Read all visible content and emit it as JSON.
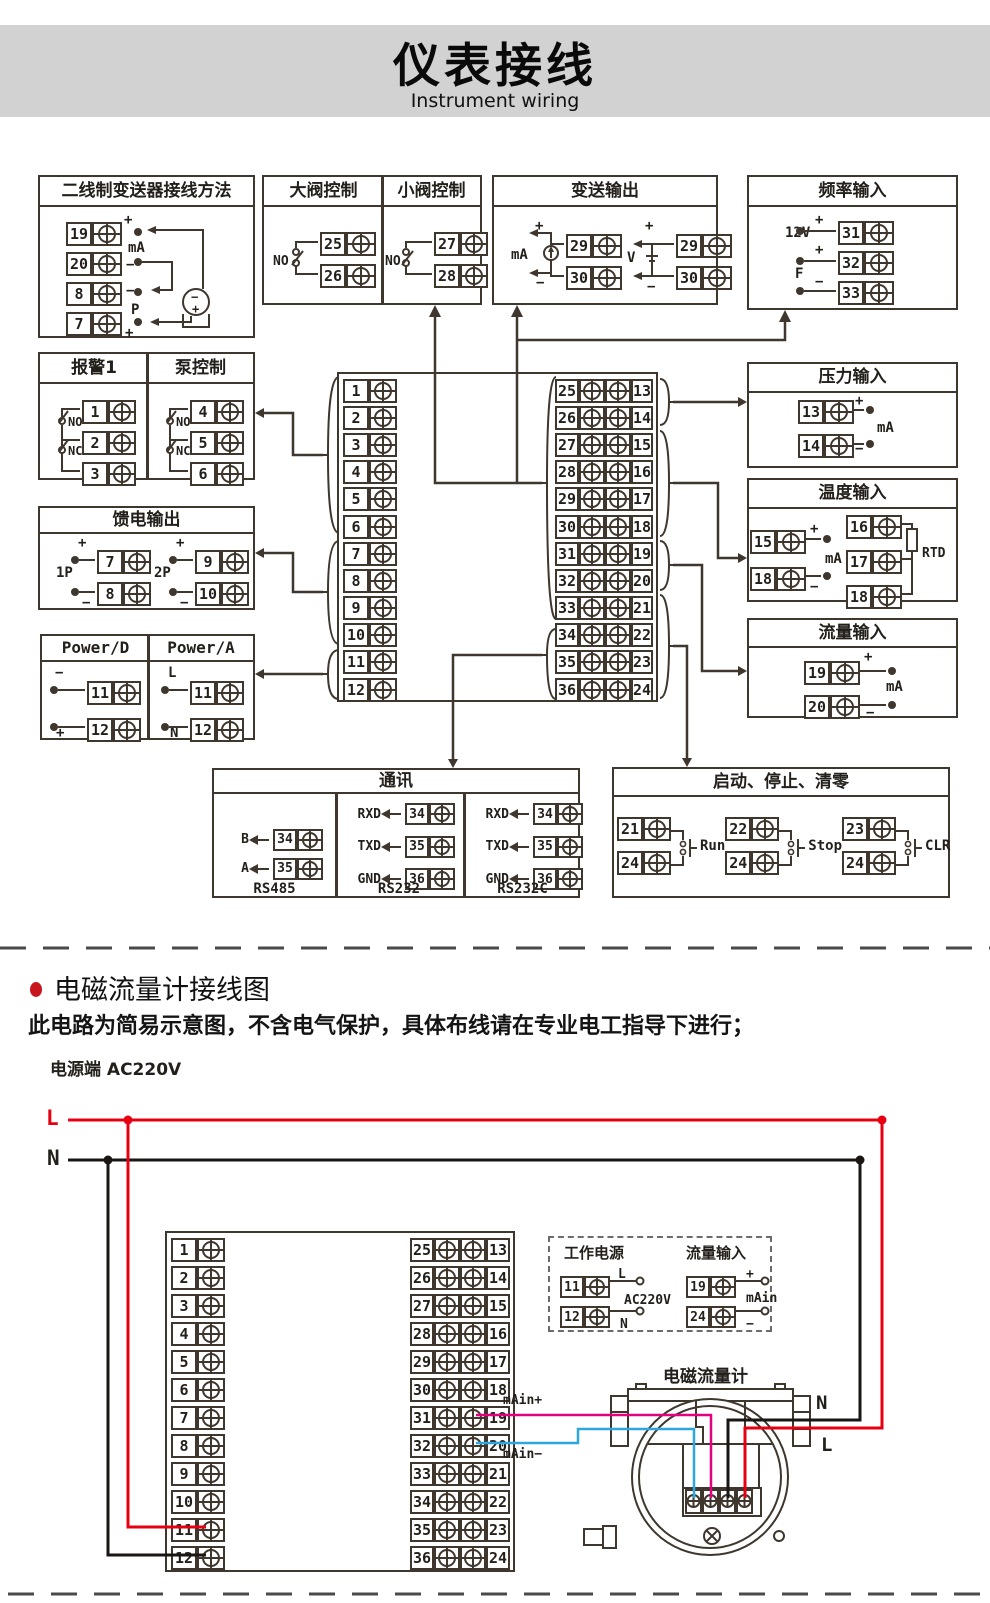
{
  "header": {
    "title": "仪表接线",
    "subtitle": "Instrument wiring"
  },
  "colors": {
    "accent_red": "#e60012",
    "wire_blue": "#2ea7e0",
    "wire_magenta": "#e5007f",
    "diagram_line": "#3f362d",
    "banner_bg": "#d2d2d2",
    "bullet_red": "#c8161e"
  },
  "two_wire": {
    "title": "二线制变送器接线方法",
    "terms": [
      "19",
      "20",
      "8",
      "7"
    ],
    "labels": [
      "+",
      "mA",
      "−",
      "−",
      "P",
      "+"
    ],
    "tx_top": "−",
    "tx_bottom": "+"
  },
  "valve": {
    "title_big": "大阀控制",
    "title_small": "小阀控制",
    "no_big": "NO",
    "no_small": "NO",
    "terms_big": [
      "25",
      "26"
    ],
    "terms_small": [
      "27",
      "28"
    ]
  },
  "trans_out": {
    "title": "变送输出",
    "plus_ma": "+",
    "ma": "mA",
    "minus_ma": "−",
    "terms_ma": [
      "29",
      "30"
    ],
    "plus_v": "+",
    "v": "V",
    "minus_v": "−",
    "terms_v": [
      "29",
      "30"
    ]
  },
  "freq": {
    "title": "频率输入",
    "v12": "12V",
    "plus1": "+",
    "plus2": "+",
    "f": "F",
    "minus": "−",
    "terms": [
      "31",
      "32",
      "33"
    ]
  },
  "alarm": {
    "title_alarm": "报警1",
    "title_pump": "泵控制",
    "no1": "NO",
    "nc1": "NC",
    "no2": "NO",
    "nc2": "NC",
    "terms_alarm": [
      "1",
      "2",
      "3"
    ],
    "terms_pump": [
      "4",
      "5",
      "6"
    ]
  },
  "feed": {
    "title": "馈电输出",
    "p1": "1P",
    "p2": "2P",
    "plus1": "+",
    "minus1": "−",
    "plus2": "+",
    "minus2": "−",
    "terms1": [
      "7",
      "8"
    ],
    "terms2": [
      "9",
      "10"
    ]
  },
  "power": {
    "title_d": "Power/D",
    "title_a": "Power/A",
    "minus": "−",
    "plus": "+",
    "l": "L",
    "n": "N",
    "terms_d": [
      "11",
      "12"
    ],
    "terms_a": [
      "11",
      "12"
    ]
  },
  "pressure": {
    "title": "压力输入",
    "plus": "+",
    "ma": "mA",
    "minus": "−",
    "terms": [
      "13",
      "14"
    ]
  },
  "temp": {
    "title": "温度输入",
    "plus": "+",
    "ma": "mA",
    "minus": "−",
    "rtd": "RTD",
    "terms_left": [
      "15",
      "18"
    ],
    "terms_right": [
      "16",
      "17",
      "18"
    ]
  },
  "flow": {
    "title": "流量输入",
    "plus": "+",
    "ma": "mA",
    "minus": "−",
    "terms": [
      "19",
      "20"
    ]
  },
  "comm": {
    "title": "通讯",
    "sections": [
      {
        "caption": "RS485",
        "rows": [
          {
            "label": "B",
            "term": "34"
          },
          {
            "label": "A",
            "term": "35"
          }
        ]
      },
      {
        "caption": "RS232",
        "rows": [
          {
            "label": "RXD",
            "term": "34"
          },
          {
            "label": "TXD",
            "term": "35"
          },
          {
            "label": "GND",
            "term": "36"
          }
        ]
      },
      {
        "caption": "RS232C",
        "rows": [
          {
            "label": "RXD",
            "term": "34"
          },
          {
            "label": "TXD",
            "term": "35"
          },
          {
            "label": "GND",
            "term": "36"
          }
        ]
      }
    ]
  },
  "startstop": {
    "title": "启动、停止、清零",
    "groups": [
      {
        "t1": "21",
        "t2": "24",
        "label": "Run"
      },
      {
        "t1": "22",
        "t2": "24",
        "label": "Stop"
      },
      {
        "t1": "23",
        "t2": "24",
        "label": "CLR"
      }
    ]
  },
  "block": {
    "left": [
      "1",
      "2",
      "3",
      "4",
      "5",
      "6",
      "7",
      "8",
      "9",
      "10",
      "11",
      "12"
    ],
    "pairs": [
      {
        "l": "25",
        "r": "13"
      },
      {
        "l": "26",
        "r": "14"
      },
      {
        "l": "27",
        "r": "15"
      },
      {
        "l": "28",
        "r": "16"
      },
      {
        "l": "29",
        "r": "17"
      },
      {
        "l": "30",
        "r": "18"
      },
      {
        "l": "31",
        "r": "19"
      },
      {
        "l": "32",
        "r": "20"
      },
      {
        "l": "33",
        "r": "21"
      },
      {
        "l": "34",
        "r": "22"
      },
      {
        "l": "35",
        "r": "23"
      },
      {
        "l": "36",
        "r": "24"
      }
    ]
  },
  "lower": {
    "section_title": "电磁流量计接线图",
    "note": "此电路为简易示意图，不含电气保护，具体布线请在专业电工指导下进行；",
    "power_label": "电源端 AC220V",
    "l": "L",
    "n": "N",
    "dashed": {
      "title_power": "工作电源",
      "title_flow": "流量输入",
      "l": "L",
      "n": "N",
      "ac": "AC220V",
      "plus": "+",
      "minus": "−",
      "main": "mAin",
      "terms_power": [
        "11",
        "12"
      ],
      "terms_flow": [
        "19",
        "24"
      ]
    },
    "meter": {
      "title": "电磁流量计",
      "n": "N",
      "l": "L",
      "main_plus": "mAin+",
      "main_minus": "mAin−",
      "terms": [
        "COM",
        "I+",
        "L2",
        "L1"
      ]
    }
  }
}
